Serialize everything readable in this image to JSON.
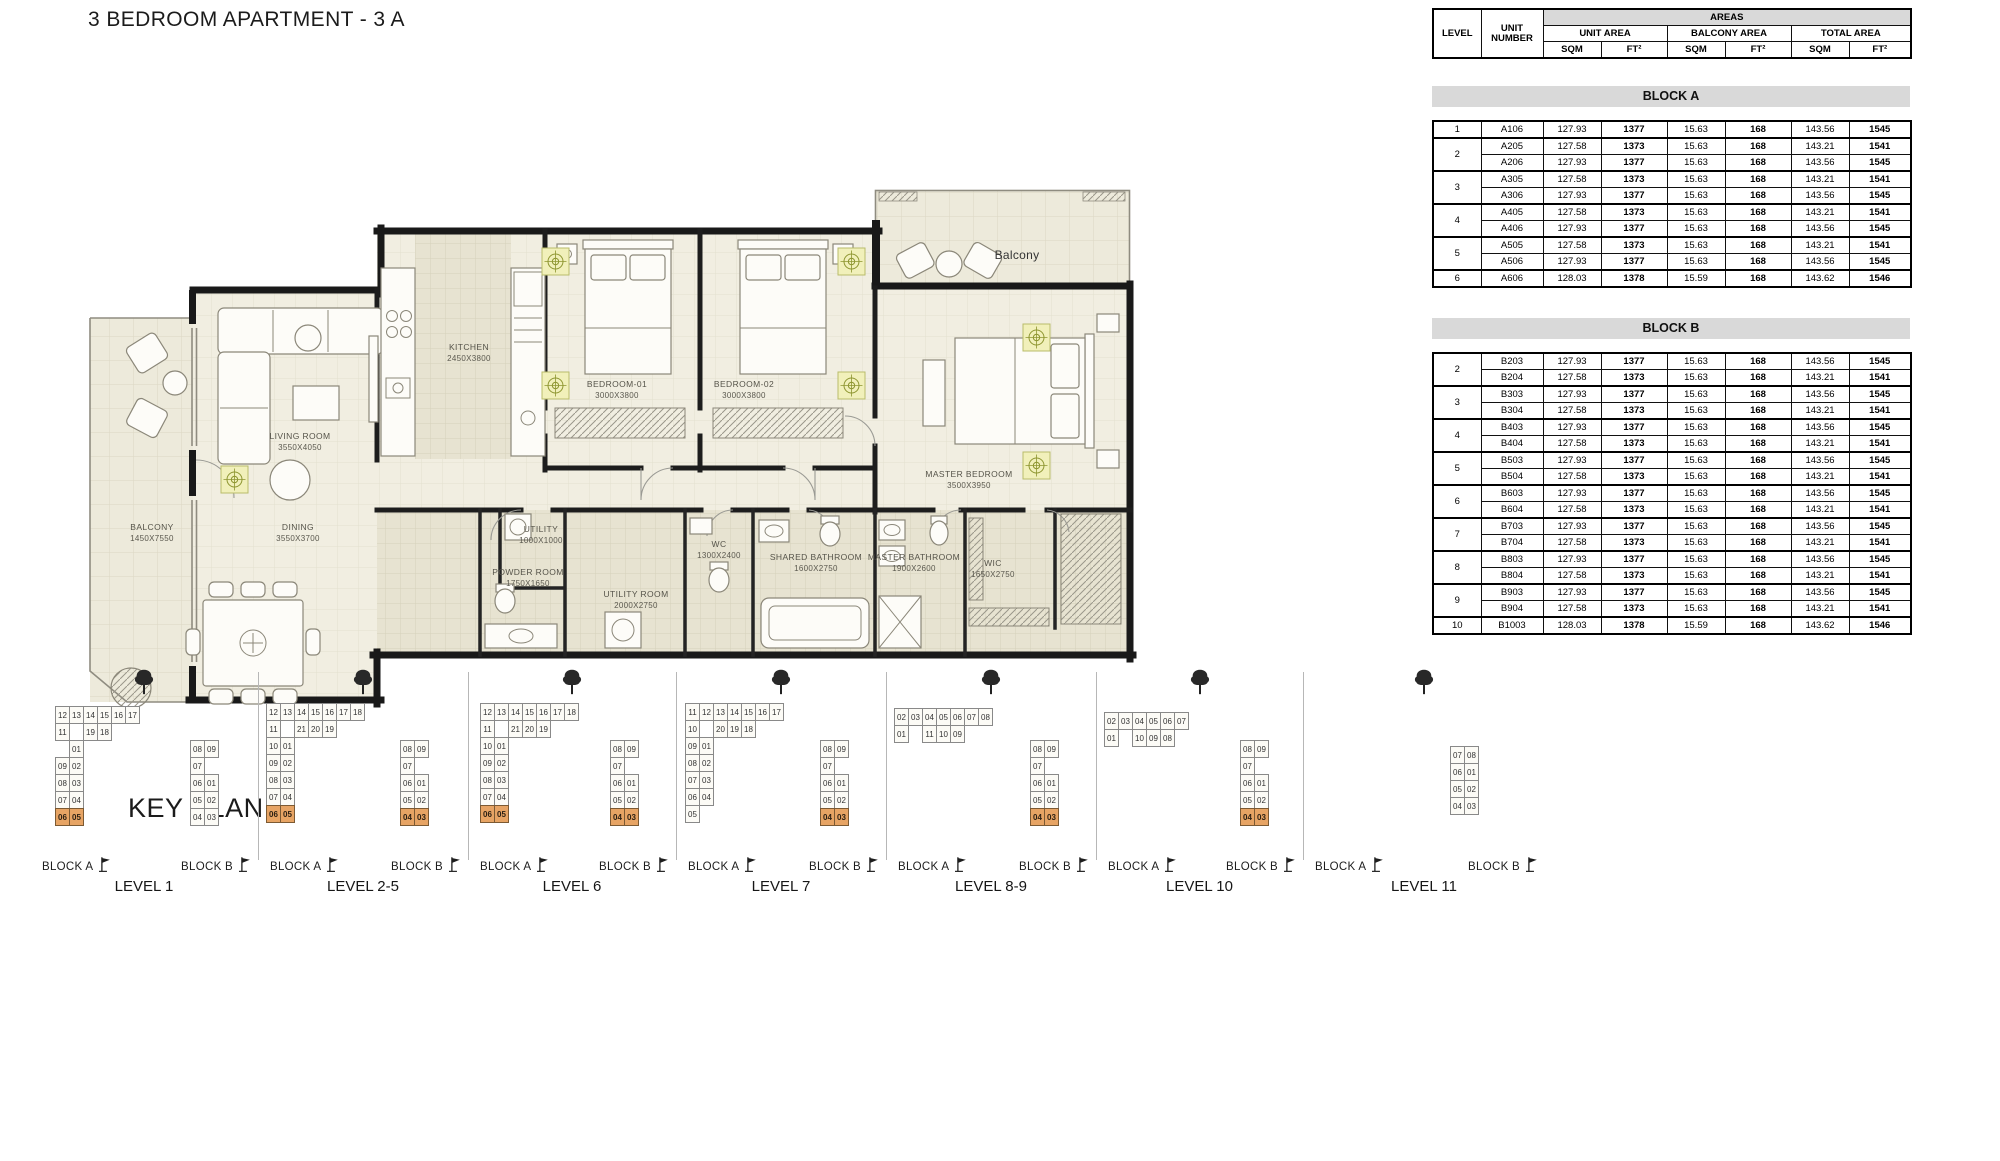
{
  "page": {
    "title": "3 BEDROOM APARTMENT - 3 A"
  },
  "floor_plan": {
    "rooms": [
      {
        "name": "KITCHEN",
        "dims": "2450X3800",
        "x": 384,
        "y": 182
      },
      {
        "name": "BEDROOM-01",
        "dims": "3000X3800",
        "x": 532,
        "y": 219
      },
      {
        "name": "BEDROOM-02",
        "dims": "3000X3800",
        "x": 659,
        "y": 219
      },
      {
        "name": "MASTER BEDROOM",
        "dims": "3500X3950",
        "x": 884,
        "y": 309
      },
      {
        "name": "LIVING ROOM",
        "dims": "3550X4050",
        "x": 215,
        "y": 271
      },
      {
        "name": "DINING",
        "dims": "3550X3700",
        "x": 213,
        "y": 362
      },
      {
        "name": "BALCONY",
        "dims": "1450X7550",
        "x": 67,
        "y": 362
      },
      {
        "name": "Balcony",
        "dims": "",
        "x": 932,
        "y": 91,
        "big": true
      },
      {
        "name": "UTILITY",
        "dims": "1000X1000",
        "x": 456,
        "y": 364
      },
      {
        "name": "POWDER ROOM",
        "dims": "1750X1650",
        "x": 443,
        "y": 407
      },
      {
        "name": "UTILITY ROOM",
        "dims": "2000X2750",
        "x": 551,
        "y": 429
      },
      {
        "name": "WC",
        "dims": "1300X2400",
        "x": 634,
        "y": 379
      },
      {
        "name": "SHARED BATHROOM",
        "dims": "1600X2750",
        "x": 731,
        "y": 392
      },
      {
        "name": "MASTER BATHROOM",
        "dims": "1900X2600",
        "x": 829,
        "y": 392
      },
      {
        "name": "WIC",
        "dims": "1650X2750",
        "x": 908,
        "y": 398
      }
    ]
  },
  "table": {
    "headers": {
      "level": "LEVEL",
      "unit": "UNIT NUMBER",
      "areas": "AREAS",
      "unit_area": "UNIT AREA",
      "balcony_area": "BALCONY AREA",
      "total_area": "TOTAL AREA",
      "sqm": "SQM",
      "ft2": "FT²"
    },
    "blocks": [
      {
        "name": "BLOCK A",
        "groups": [
          {
            "level": "1",
            "rows": [
              [
                "A106",
                "127.93",
                "1377",
                "15.63",
                "168",
                "143.56",
                "1545"
              ]
            ]
          },
          {
            "level": "2",
            "rows": [
              [
                "A205",
                "127.58",
                "1373",
                "15.63",
                "168",
                "143.21",
                "1541"
              ],
              [
                "A206",
                "127.93",
                "1377",
                "15.63",
                "168",
                "143.56",
                "1545"
              ]
            ]
          },
          {
            "level": "3",
            "rows": [
              [
                "A305",
                "127.58",
                "1373",
                "15.63",
                "168",
                "143.21",
                "1541"
              ],
              [
                "A306",
                "127.93",
                "1377",
                "15.63",
                "168",
                "143.56",
                "1545"
              ]
            ]
          },
          {
            "level": "4",
            "rows": [
              [
                "A405",
                "127.58",
                "1373",
                "15.63",
                "168",
                "143.21",
                "1541"
              ],
              [
                "A406",
                "127.93",
                "1377",
                "15.63",
                "168",
                "143.56",
                "1545"
              ]
            ]
          },
          {
            "level": "5",
            "rows": [
              [
                "A505",
                "127.58",
                "1373",
                "15.63",
                "168",
                "143.21",
                "1541"
              ],
              [
                "A506",
                "127.93",
                "1377",
                "15.63",
                "168",
                "143.56",
                "1545"
              ]
            ]
          },
          {
            "level": "6",
            "rows": [
              [
                "A606",
                "128.03",
                "1378",
                "15.59",
                "168",
                "143.62",
                "1546"
              ]
            ]
          }
        ]
      },
      {
        "name": "BLOCK B",
        "groups": [
          {
            "level": "2",
            "rows": [
              [
                "B203",
                "127.93",
                "1377",
                "15.63",
                "168",
                "143.56",
                "1545"
              ],
              [
                "B204",
                "127.58",
                "1373",
                "15.63",
                "168",
                "143.21",
                "1541"
              ]
            ]
          },
          {
            "level": "3",
            "rows": [
              [
                "B303",
                "127.93",
                "1377",
                "15.63",
                "168",
                "143.56",
                "1545"
              ],
              [
                "B304",
                "127.58",
                "1373",
                "15.63",
                "168",
                "143.21",
                "1541"
              ]
            ]
          },
          {
            "level": "4",
            "rows": [
              [
                "B403",
                "127.93",
                "1377",
                "15.63",
                "168",
                "143.56",
                "1545"
              ],
              [
                "B404",
                "127.58",
                "1373",
                "15.63",
                "168",
                "143.21",
                "1541"
              ]
            ]
          },
          {
            "level": "5",
            "rows": [
              [
                "B503",
                "127.93",
                "1377",
                "15.63",
                "168",
                "143.56",
                "1545"
              ],
              [
                "B504",
                "127.58",
                "1373",
                "15.63",
                "168",
                "143.21",
                "1541"
              ]
            ]
          },
          {
            "level": "6",
            "rows": [
              [
                "B603",
                "127.93",
                "1377",
                "15.63",
                "168",
                "143.56",
                "1545"
              ],
              [
                "B604",
                "127.58",
                "1373",
                "15.63",
                "168",
                "143.21",
                "1541"
              ]
            ]
          },
          {
            "level": "7",
            "rows": [
              [
                "B703",
                "127.93",
                "1377",
                "15.63",
                "168",
                "143.56",
                "1545"
              ],
              [
                "B704",
                "127.58",
                "1373",
                "15.63",
                "168",
                "143.21",
                "1541"
              ]
            ]
          },
          {
            "level": "8",
            "rows": [
              [
                "B803",
                "127.93",
                "1377",
                "15.63",
                "168",
                "143.56",
                "1545"
              ],
              [
                "B804",
                "127.58",
                "1373",
                "15.63",
                "168",
                "143.21",
                "1541"
              ]
            ]
          },
          {
            "level": "9",
            "rows": [
              [
                "B903",
                "127.93",
                "1377",
                "15.63",
                "168",
                "143.56",
                "1545"
              ],
              [
                "B904",
                "127.58",
                "1373",
                "15.63",
                "168",
                "143.21",
                "1541"
              ]
            ]
          },
          {
            "level": "10",
            "rows": [
              [
                "B1003",
                "128.03",
                "1378",
                "15.59",
                "168",
                "143.62",
                "1546"
              ]
            ]
          }
        ]
      }
    ]
  },
  "key_plan": {
    "title": "KEY PLAN",
    "block_a_label": "BLOCK A",
    "block_b_label": "BLOCK B",
    "highlight_color": "#E7A464",
    "plans": {
      "towerA1": [
        [
          "12",
          "13",
          "14",
          "15",
          "16",
          "17"
        ],
        [
          "11",
          null,
          "19",
          "18"
        ],
        [
          null,
          "01"
        ],
        [
          "09",
          "02"
        ],
        [
          "08",
          "03"
        ],
        [
          "07",
          "04"
        ],
        [
          "06",
          "05"
        ]
      ],
      "towerA2": [
        [
          "12",
          "13",
          "14",
          "15",
          "16",
          "17",
          "18"
        ],
        [
          "11",
          null,
          "21",
          "20",
          "19"
        ],
        [
          "10",
          "01"
        ],
        [
          "09",
          "02"
        ],
        [
          "08",
          "03"
        ],
        [
          "07",
          "04"
        ],
        [
          "06",
          "05"
        ]
      ],
      "towerA7": [
        [
          "11",
          "12",
          "13",
          "14",
          "15",
          "16",
          "17"
        ],
        [
          "10",
          null,
          "20",
          "19",
          "18"
        ],
        [
          "09",
          "01"
        ],
        [
          "08",
          "02"
        ],
        [
          "07",
          "03"
        ],
        [
          "06",
          "04"
        ],
        [
          "05",
          null
        ]
      ],
      "horizA89": [
        [
          "02",
          "03",
          "04",
          "05",
          "06",
          "07",
          "08"
        ],
        [
          "01",
          null,
          "11",
          "10",
          "09"
        ]
      ],
      "horizA10": [
        [
          "02",
          "03",
          "04",
          "05",
          "06",
          "07"
        ],
        [
          "01",
          null,
          "10",
          "09",
          "08"
        ]
      ],
      "towerB": [
        [
          "08",
          "09"
        ],
        [
          "07",
          null
        ],
        [
          "06",
          "01"
        ],
        [
          "05",
          "02"
        ],
        [
          "04",
          "03"
        ]
      ],
      "towerB11": [
        [
          "07",
          "08"
        ],
        [
          "06",
          "01"
        ],
        [
          "05",
          "02"
        ],
        [
          "04",
          "03"
        ]
      ]
    },
    "groups": [
      {
        "level": "LEVEL 1",
        "a_plan": "towerA1",
        "a_highlights": [
          "06",
          "05"
        ],
        "b_plan": "towerB",
        "b_highlights": []
      },
      {
        "level": "LEVEL 2-5",
        "a_plan": "towerA2",
        "a_highlights": [
          "06",
          "05"
        ],
        "b_plan": "towerB",
        "b_highlights": [
          "04",
          "03"
        ]
      },
      {
        "level": "LEVEL 6",
        "a_plan": "towerA2",
        "a_highlights": [
          "06",
          "05"
        ],
        "b_plan": "towerB",
        "b_highlights": [
          "04",
          "03"
        ]
      },
      {
        "level": "LEVEL 7",
        "a_plan": "towerA7",
        "a_highlights": [],
        "b_plan": "towerB",
        "b_highlights": [
          "04",
          "03"
        ]
      },
      {
        "level": "LEVEL 8-9",
        "a_plan": "horizA89",
        "a_highlights": [],
        "b_plan": "towerB",
        "b_highlights": [
          "04",
          "03"
        ]
      },
      {
        "level": "LEVEL 10",
        "a_plan": "horizA10",
        "a_highlights": [],
        "b_plan": "towerB",
        "b_highlights": [
          "04",
          "03"
        ]
      },
      {
        "level": "LEVEL 11",
        "a_plan": null,
        "a_highlights": [],
        "b_plan": "towerB11",
        "b_highlights": []
      }
    ]
  }
}
